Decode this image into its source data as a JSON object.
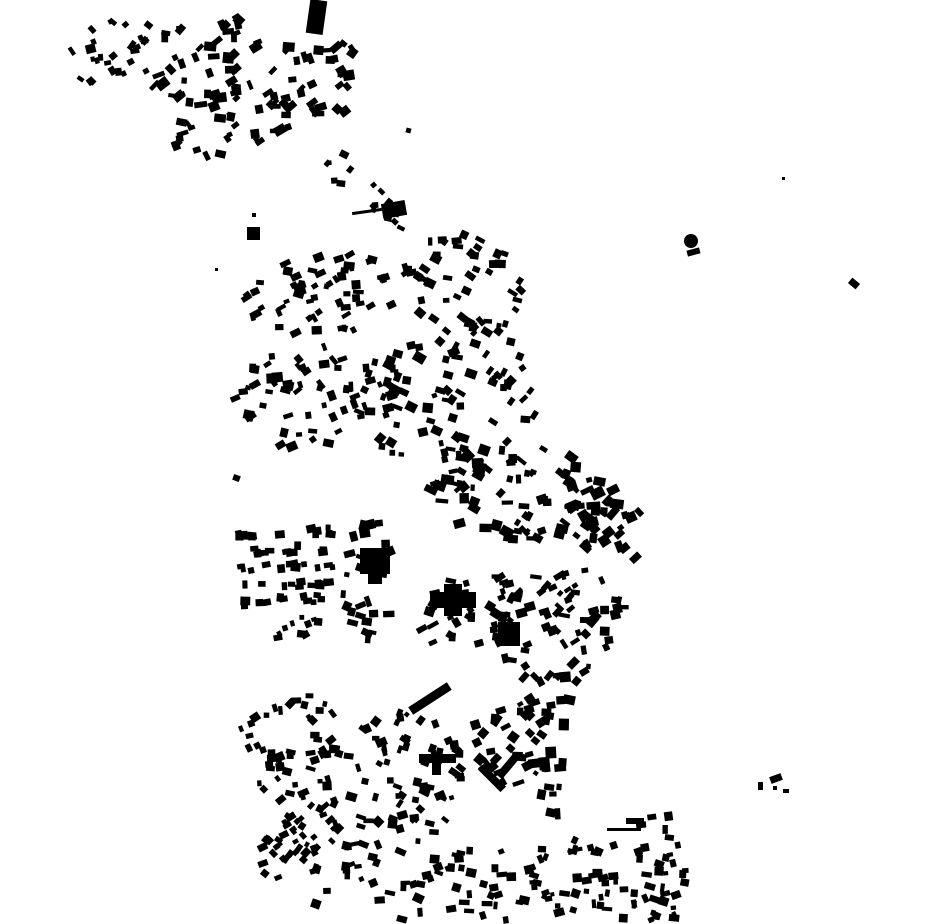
{
  "map": {
    "canvas": {
      "width": 930,
      "height": 924,
      "background_color": "#ffffff",
      "building_color": "#000000"
    },
    "clusters": [
      {
        "name": "nw-hamlet-west",
        "seed": 101,
        "cx": 113,
        "cy": 50,
        "rx": 48,
        "ry": 30,
        "rot": -30,
        "shape": "ellipse",
        "n": 26,
        "wmin": 4,
        "wmax": 10,
        "hmin": 4,
        "hmax": 9,
        "angle": -30,
        "jitter": 28
      },
      {
        "name": "nw-hamlet-mid",
        "seed": 102,
        "cx": 205,
        "cy": 62,
        "rx": 62,
        "ry": 46,
        "rot": -20,
        "shape": "ellipse",
        "n": 42,
        "wmin": 5,
        "wmax": 13,
        "hmin": 4,
        "hmax": 11,
        "angle": -20,
        "jitter": 30
      },
      {
        "name": "nw-hamlet-south",
        "seed": 103,
        "cx": 230,
        "cy": 118,
        "rx": 72,
        "ry": 36,
        "rot": -12,
        "shape": "ellipse",
        "n": 38,
        "wmin": 4,
        "wmax": 12,
        "hmin": 4,
        "hmax": 10,
        "angle": -15,
        "jitter": 30
      },
      {
        "name": "nw-hamlet-east",
        "seed": 104,
        "cx": 315,
        "cy": 82,
        "rx": 52,
        "ry": 44,
        "rot": -25,
        "shape": "ellipse",
        "n": 34,
        "wmin": 5,
        "wmax": 13,
        "hmin": 4,
        "hmax": 11,
        "angle": -25,
        "jitter": 30
      },
      {
        "name": "north-road-trail",
        "seed": 105,
        "cx": 365,
        "cy": 190,
        "rx": 55,
        "ry": 20,
        "rot": 49,
        "shape": "ellipse",
        "n": 18,
        "wmin": 4,
        "wmax": 9,
        "hmin": 4,
        "hmax": 8,
        "angle": 20,
        "jitter": 30
      },
      {
        "name": "upper-band-west",
        "seed": 106,
        "cx": 330,
        "cy": 292,
        "rx": 92,
        "ry": 42,
        "rot": -8,
        "shape": "ellipse",
        "n": 60,
        "wmin": 4,
        "wmax": 11,
        "hmin": 4,
        "hmax": 9,
        "angle": -10,
        "jitter": 28
      },
      {
        "name": "upper-band-east",
        "seed": 107,
        "cx": 465,
        "cy": 285,
        "rx": 60,
        "ry": 50,
        "rot": 20,
        "shape": "ellipse",
        "n": 45,
        "wmin": 4,
        "wmax": 11,
        "hmin": 4,
        "hmax": 9,
        "angle": 15,
        "jitter": 30
      },
      {
        "name": "mid-band-west",
        "seed": 108,
        "cx": 300,
        "cy": 398,
        "rx": 68,
        "ry": 55,
        "rot": -8,
        "shape": "ellipse",
        "n": 50,
        "wmin": 4,
        "wmax": 12,
        "hmin": 4,
        "hmax": 10,
        "angle": -10,
        "jitter": 30
      },
      {
        "name": "mid-band-center",
        "seed": 109,
        "cx": 425,
        "cy": 400,
        "rx": 72,
        "ry": 62,
        "rot": 8,
        "shape": "ellipse",
        "n": 65,
        "wmin": 4,
        "wmax": 12,
        "hmin": 4,
        "hmax": 10,
        "angle": 10,
        "jitter": 32
      },
      {
        "name": "mid-band-diagonal",
        "seed": 110,
        "cx": 502,
        "cy": 365,
        "rx": 70,
        "ry": 20,
        "rot": 63,
        "shape": "ellipse",
        "n": 26,
        "wmin": 4,
        "wmax": 10,
        "hmin": 4,
        "hmax": 9,
        "angle": 25,
        "jitter": 30
      },
      {
        "name": "center-north",
        "seed": 111,
        "cx": 520,
        "cy": 492,
        "rx": 92,
        "ry": 50,
        "rot": 8,
        "shape": "ellipse",
        "n": 80,
        "wmin": 4,
        "wmax": 13,
        "hmin": 4,
        "hmax": 11,
        "angle": 15,
        "jitter": 35
      },
      {
        "name": "center-east",
        "seed": 112,
        "cx": 606,
        "cy": 520,
        "rx": 36,
        "ry": 52,
        "rot": -18,
        "shape": "ellipse",
        "n": 30,
        "wmin": 5,
        "wmax": 14,
        "hmin": 4,
        "hmax": 12,
        "angle": -20,
        "jitter": 30
      },
      {
        "name": "center-plaza-ring",
        "seed": 113,
        "cx": 470,
        "cy": 612,
        "rx": 55,
        "ry": 42,
        "rot": 0,
        "shape": "ellipse",
        "n": 38,
        "wmin": 4,
        "wmax": 12,
        "hmin": 4,
        "hmax": 10,
        "angle": 0,
        "jitter": 35
      },
      {
        "name": "center-south-east",
        "seed": 114,
        "cx": 560,
        "cy": 628,
        "rx": 68,
        "ry": 60,
        "rot": -20,
        "shape": "ellipse",
        "n": 65,
        "wmin": 4,
        "wmax": 12,
        "hmin": 4,
        "hmax": 10,
        "angle": -20,
        "jitter": 35
      },
      {
        "name": "mid-left-column",
        "seed": 115,
        "cx": 368,
        "cy": 582,
        "rx": 26,
        "ry": 66,
        "rot": 0,
        "shape": "ellipse",
        "n": 30,
        "wmin": 4,
        "wmax": 12,
        "hmin": 4,
        "hmax": 11,
        "angle": 0,
        "jitter": 25
      },
      {
        "name": "left-grid-row-1",
        "seed": 116,
        "cx": 285,
        "cy": 533,
        "rx": 48,
        "ry": 4,
        "rot": -3,
        "shape": "rect",
        "n": 12,
        "wmin": 5,
        "wmax": 10,
        "hmin": 5,
        "hmax": 9,
        "angle": -3,
        "jitter": 10
      },
      {
        "name": "left-grid-row-2",
        "seed": 117,
        "cx": 285,
        "cy": 550,
        "rx": 48,
        "ry": 4,
        "rot": -3,
        "shape": "rect",
        "n": 12,
        "wmin": 5,
        "wmax": 10,
        "hmin": 5,
        "hmax": 9,
        "angle": -3,
        "jitter": 10
      },
      {
        "name": "left-grid-row-3",
        "seed": 118,
        "cx": 285,
        "cy": 567,
        "rx": 48,
        "ry": 4,
        "rot": -3,
        "shape": "rect",
        "n": 12,
        "wmin": 5,
        "wmax": 10,
        "hmin": 5,
        "hmax": 9,
        "angle": -3,
        "jitter": 10
      },
      {
        "name": "left-grid-row-4",
        "seed": 119,
        "cx": 285,
        "cy": 584,
        "rx": 48,
        "ry": 4,
        "rot": -3,
        "shape": "rect",
        "n": 12,
        "wmin": 5,
        "wmax": 10,
        "hmin": 5,
        "hmax": 9,
        "angle": -3,
        "jitter": 10
      },
      {
        "name": "left-grid-row-5",
        "seed": 120,
        "cx": 280,
        "cy": 601,
        "rx": 42,
        "ry": 4,
        "rot": -3,
        "shape": "rect",
        "n": 11,
        "wmin": 5,
        "wmax": 10,
        "hmin": 5,
        "hmax": 9,
        "angle": -3,
        "jitter": 10
      },
      {
        "name": "left-grid-tail",
        "seed": 121,
        "cx": 300,
        "cy": 628,
        "rx": 28,
        "ry": 12,
        "rot": -15,
        "shape": "ellipse",
        "n": 10,
        "wmin": 4,
        "wmax": 9,
        "hmin": 4,
        "hmax": 8,
        "angle": -10,
        "jitter": 20
      },
      {
        "name": "southwest-blocks",
        "seed": 122,
        "cx": 292,
        "cy": 748,
        "rx": 58,
        "ry": 55,
        "rot": -8,
        "shape": "ellipse",
        "n": 55,
        "wmin": 4,
        "wmax": 11,
        "hmin": 4,
        "hmax": 9,
        "angle": -15,
        "jitter": 32
      },
      {
        "name": "southwest-wedge",
        "seed": 123,
        "cx": 300,
        "cy": 838,
        "rx": 52,
        "ry": 26,
        "rot": -42,
        "shape": "ellipse",
        "n": 48,
        "wmin": 4,
        "wmax": 10,
        "hmin": 4,
        "hmax": 8,
        "angle": -42,
        "jitter": 25
      },
      {
        "name": "south-center",
        "seed": 124,
        "cx": 402,
        "cy": 778,
        "rx": 60,
        "ry": 70,
        "rot": 12,
        "shape": "ellipse",
        "n": 70,
        "wmin": 4,
        "wmax": 11,
        "hmin": 4,
        "hmax": 9,
        "angle": 10,
        "jitter": 35
      },
      {
        "name": "south-mid-east",
        "seed": 125,
        "cx": 512,
        "cy": 740,
        "rx": 45,
        "ry": 46,
        "rot": -25,
        "shape": "ellipse",
        "n": 40,
        "wmin": 4,
        "wmax": 12,
        "hmin": 4,
        "hmax": 10,
        "angle": -25,
        "jitter": 32
      },
      {
        "name": "south-column",
        "seed": 126,
        "cx": 556,
        "cy": 748,
        "rx": 12,
        "ry": 75,
        "rot": 4,
        "shape": "rect",
        "n": 18,
        "wmin": 5,
        "wmax": 12,
        "hmin": 5,
        "hmax": 13,
        "angle": 2,
        "jitter": 15
      },
      {
        "name": "bottom-strip",
        "seed": 127,
        "cx": 500,
        "cy": 880,
        "rx": 190,
        "ry": 40,
        "rot": 0,
        "shape": "rect",
        "n": 120,
        "wmin": 4,
        "wmax": 11,
        "hmin": 4,
        "hmax": 9,
        "angle": 0,
        "jitter": 25
      },
      {
        "name": "bottom-right-columns",
        "seed": 128,
        "cx": 655,
        "cy": 865,
        "rx": 28,
        "ry": 50,
        "rot": 0,
        "shape": "rect",
        "n": 22,
        "wmin": 4,
        "wmax": 10,
        "hmin": 4,
        "hmax": 9,
        "angle": 5,
        "jitter": 20
      }
    ],
    "landmarks": [
      {
        "type": "rect",
        "name": "tower-block-north",
        "x": 308,
        "y": 0,
        "w": 17,
        "h": 34,
        "rot": 8
      },
      {
        "type": "circle",
        "name": "water-tower-circle",
        "cx": 691,
        "cy": 241,
        "r": 7
      },
      {
        "type": "rect",
        "name": "water-tower-base",
        "x": 687,
        "y": 249,
        "w": 13,
        "h": 6,
        "rot": -15
      },
      {
        "type": "rect",
        "name": "isolated-dot-northeast",
        "x": 782,
        "y": 177,
        "w": 3,
        "h": 3,
        "rot": 0
      },
      {
        "type": "rect",
        "name": "isolated-diamond-east",
        "x": 849,
        "y": 280,
        "w": 10,
        "h": 7,
        "rot": 40
      },
      {
        "type": "rect",
        "name": "isolated-square-west",
        "x": 247,
        "y": 227,
        "w": 13,
        "h": 13,
        "rot": 0
      },
      {
        "type": "rect",
        "name": "isolated-dot-a",
        "x": 252,
        "y": 213,
        "w": 4,
        "h": 4,
        "rot": 0
      },
      {
        "type": "rect",
        "name": "isolated-dot-b",
        "x": 215,
        "y": 268,
        "w": 3,
        "h": 3,
        "rot": 0
      },
      {
        "type": "rect",
        "name": "isolated-dot-c",
        "x": 233,
        "y": 475,
        "w": 7,
        "h": 6,
        "rot": 20
      },
      {
        "type": "rect",
        "name": "isolated-dot-d",
        "x": 406,
        "y": 128,
        "w": 5,
        "h": 5,
        "rot": 15
      },
      {
        "type": "rect",
        "name": "north-trail-hall",
        "x": 382,
        "y": 202,
        "w": 24,
        "h": 15,
        "rot": -10
      },
      {
        "type": "rect",
        "name": "north-trail-wall",
        "x": 352,
        "y": 210,
        "w": 30,
        "h": 3,
        "rot": -8
      },
      {
        "type": "rect",
        "name": "west-blob-main",
        "x": 360,
        "y": 548,
        "w": 30,
        "h": 26,
        "rot": 0
      },
      {
        "type": "rect",
        "name": "west-blob-annex",
        "x": 368,
        "y": 572,
        "w": 14,
        "h": 12,
        "rot": 0
      },
      {
        "type": "rect",
        "name": "cross-hall-bar",
        "x": 430,
        "y": 592,
        "w": 46,
        "h": 16,
        "rot": 0
      },
      {
        "type": "rect",
        "name": "cross-hall-stem",
        "x": 444,
        "y": 584,
        "w": 18,
        "h": 32,
        "rot": 0
      },
      {
        "type": "rect",
        "name": "plaza-big-square",
        "x": 498,
        "y": 622,
        "w": 22,
        "h": 24,
        "rot": 0
      },
      {
        "type": "rect",
        "name": "t-building-bar",
        "x": 419,
        "y": 754,
        "w": 37,
        "h": 9,
        "rot": 0
      },
      {
        "type": "rect",
        "name": "t-building-stem",
        "x": 432,
        "y": 763,
        "w": 9,
        "h": 12,
        "rot": 0
      },
      {
        "type": "rect",
        "name": "diagonal-arrow-hall",
        "x": 407,
        "y": 694,
        "w": 46,
        "h": 9,
        "rot": -33
      },
      {
        "type": "rect",
        "name": "chevron-bar-a",
        "x": 476,
        "y": 774,
        "w": 32,
        "h": 8,
        "rot": 45
      },
      {
        "type": "rect",
        "name": "chevron-bar-b",
        "x": 494,
        "y": 762,
        "w": 28,
        "h": 8,
        "rot": -50
      },
      {
        "type": "rect",
        "name": "long-thin-wall",
        "x": 607,
        "y": 828,
        "w": 34,
        "h": 3,
        "rot": 0
      },
      {
        "type": "rect",
        "name": "long-wall-annex",
        "x": 626,
        "y": 818,
        "w": 18,
        "h": 6,
        "rot": 0
      },
      {
        "type": "rect",
        "name": "se-outlier-a",
        "x": 758,
        "y": 782,
        "w": 5,
        "h": 8,
        "rot": 0
      },
      {
        "type": "rect",
        "name": "se-outlier-b",
        "x": 770,
        "y": 775,
        "w": 12,
        "h": 7,
        "rot": -20
      },
      {
        "type": "rect",
        "name": "se-outlier-c",
        "x": 773,
        "y": 786,
        "w": 4,
        "h": 4,
        "rot": 0
      },
      {
        "type": "rect",
        "name": "se-outlier-d",
        "x": 783,
        "y": 789,
        "w": 6,
        "h": 4,
        "rot": 0
      }
    ]
  }
}
